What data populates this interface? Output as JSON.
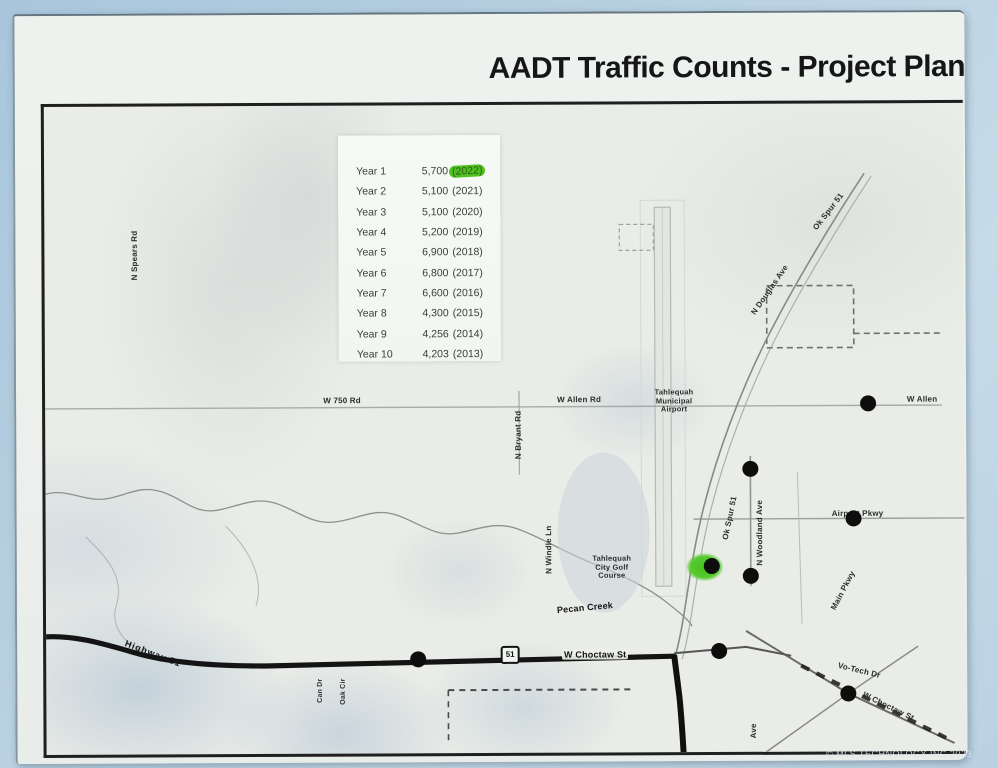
{
  "header": {
    "title": "AADT Traffic Counts - Project Plann"
  },
  "photo": {
    "copyright": "© MLS TECHNOLOGY INC 2023"
  },
  "aadt": {
    "rows": [
      {
        "year": "Year 1",
        "count": "5,700",
        "cal": "(2022)"
      },
      {
        "year": "Year 2",
        "count": "5,100",
        "cal": "(2021)"
      },
      {
        "year": "Year 3",
        "count": "5,100",
        "cal": "(2020)"
      },
      {
        "year": "Year 4",
        "count": "5,200",
        "cal": "(2019)"
      },
      {
        "year": "Year 5",
        "count": "6,900",
        "cal": "(2018)"
      },
      {
        "year": "Year 6",
        "count": "6,800",
        "cal": "(2017)"
      },
      {
        "year": "Year 7",
        "count": "6,600",
        "cal": "(2016)"
      },
      {
        "year": "Year 8",
        "count": "4,300",
        "cal": "(2015)"
      },
      {
        "year": "Year 9",
        "count": "4,256",
        "cal": "(2014)"
      },
      {
        "year": "Year 10",
        "count": "4,203",
        "cal": "(2013)"
      }
    ],
    "highlight_color": "#4fc11f"
  },
  "map": {
    "labels": {
      "n_spears_rd": "N Spears Rd",
      "w_750_rd": "W 750 Rd",
      "n_bryant_rd": "N Bryant Rd",
      "w_allen_rd": "W Allen Rd",
      "airport_1": "Tahlequah",
      "airport_2": "Municipal",
      "airport_3": "Airport",
      "ok_spur_51_top": "Ok Spur 51",
      "n_douglas_ave": "N Douglas Ave",
      "w_allen_right": "W Allen",
      "ok_spur_51_mid": "Ok Spur 51",
      "n_woodland_ave": "N Woodland Ave",
      "airport_pkwy": "Airport Pkwy",
      "n_windle_ln": "N Windle Ln",
      "golf_1": "Tahlequah",
      "golf_2": "City Golf",
      "golf_3": "Course",
      "pecan_creek": "Pecan Creek",
      "highway_51": "Highway 51",
      "w_choctaw_st": "W Choctaw St",
      "vo_tech_dr": "Vo-Tech Dr",
      "w_choctaw_st_2": "W Choctaw St",
      "ave": "Ave",
      "main_pkwy": "Main Pkwy",
      "can_dr": "Can Dr",
      "oak_cir": "Oak Cir",
      "shield_51": "51"
    }
  }
}
